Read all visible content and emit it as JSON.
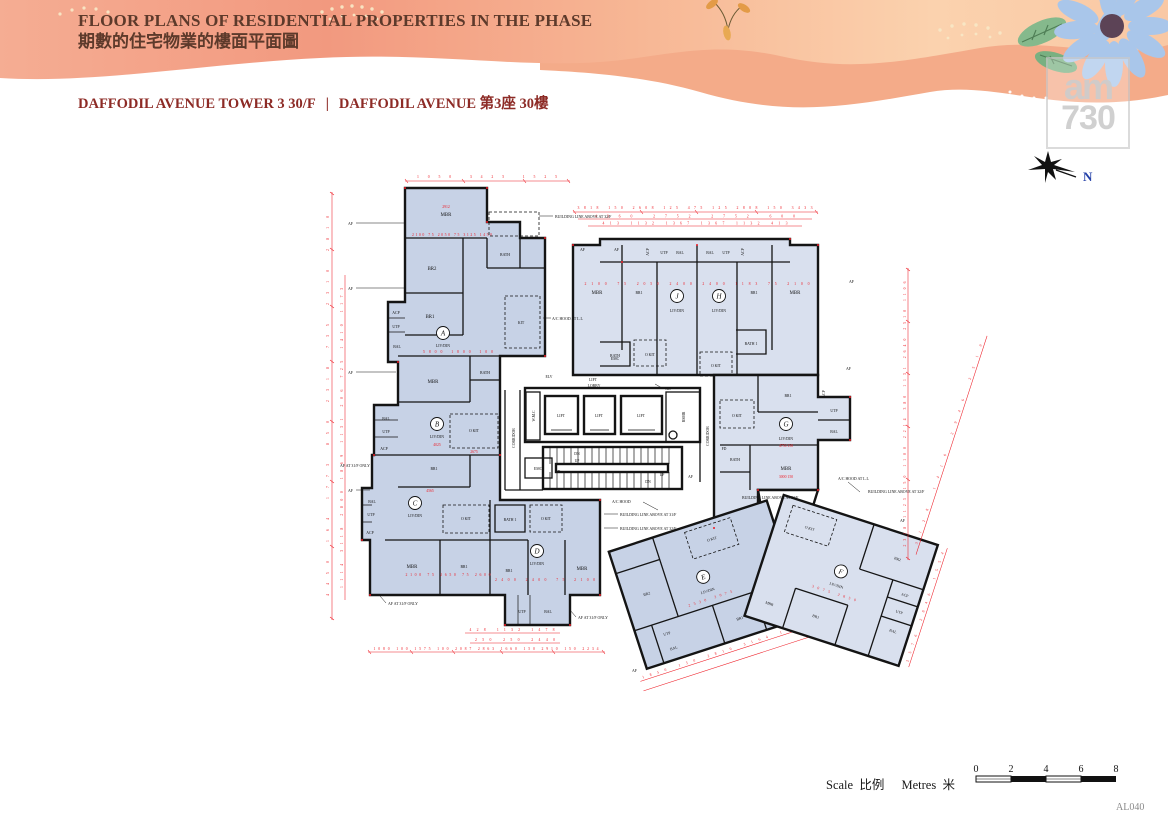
{
  "header": {
    "title_en": "FLOOR PLANS OF RESIDENTIAL PROPERTIES IN THE PHASE",
    "title_zh": "期數的住宅物業的樓面平面圖",
    "subtitle_tower_en": "DAFFODIL AVENUE TOWER 3  30/F",
    "subtitle_divider": "|",
    "subtitle_street_en": "DAFFODIL AVENUE",
    "subtitle_zh": "第3座 30樓"
  },
  "watermark": {
    "line1": "am",
    "line2": "730"
  },
  "compass": {
    "north": "N"
  },
  "page": {
    "code": "AL040"
  },
  "scale_bar": {
    "scale_en": "Scale",
    "scale_zh": "比例",
    "metres_en": "Metres",
    "metres_zh": "米",
    "ticks": [
      "0",
      "2",
      "4",
      "6",
      "8"
    ]
  },
  "units": {
    "A": "A",
    "B": "B",
    "C": "C",
    "D": "D",
    "E": "E",
    "F": "F",
    "G": "G",
    "H": "H",
    "J": "J"
  },
  "labels": {
    "livdin": "LIV/DIN",
    "mbr": "MBR",
    "br1": "BR1",
    "br2": "BR2",
    "bath": "BATH",
    "bath1": "BATH 1",
    "kit": "KIT",
    "okit": "O KIT",
    "bal": "BAL",
    "utp": "UTP",
    "acp": "ACP",
    "lift": "LIFT",
    "lobby": "LOBBY",
    "corridor": "CORRIDOR",
    "wmc": "W.M.C",
    "emc": "EMC",
    "rsmr": "RSMR",
    "pd": "PD",
    "hr": "HR",
    "elv": "ELV",
    "fd": "FD",
    "dn": "DN",
    "up": "UP",
    "af": "AF"
  },
  "annotations": {
    "building_line_32": "BUILDING LINE ABOVE AT 32/F",
    "building_line_31": "BUILDING LINE ABOVE AT 31/F",
    "ac_hood": "A/C HOOD",
    "ac_hood_ll": "A/C HOOD AT L.L",
    "af_31f_only": "AF AT 31/F ONLY"
  },
  "dims": {
    "top_a": "1050  3425  1525",
    "jh_row1": "3818 150 2608 125 475 125 2808 150 3433",
    "jh_row2": "4360    2752    2752    600",
    "jh_row3": "413 1132 1367    1367 1132 413",
    "left_1": "4450  164 1773  850  2318  735  2310  2810",
    "left_2": "1114  3118  2800  1869 1131 206  725  1410 1173",
    "right_1": "2318 1123 150 1100 2214 380 1131 2640 2510 1106",
    "right_2": "3128  1410  2946  2510",
    "bottom_1": "428 1132 1478",
    "bottom_2": "250 250  2440",
    "bottom_3": "1080 100 1575 100 2087  2863 1660 150 2910 150 2234",
    "wing_e": "1850 150 2816  3164  1554",
    "wing_f": "2576  2846  1554",
    "a_mbr": "2912",
    "a_beds": "2100 75 2050 75 3125 1450",
    "a_liv": "5800  1800 100",
    "b_liv": "4025",
    "b_okit": "2675",
    "c_liv": "4565",
    "c_beds": "2100 75 2650 75 2600",
    "d_beds": "2400   2400 75 2100",
    "d_low": "850  1600  1555   2012",
    "jh_beds": "2100 75 2050  2400  2400  1183 75 2100",
    "g_liv": "4750 150",
    "g_mbr": "3000 150",
    "e_liv": "2530  3075",
    "f_liv": "3075  2850"
  },
  "colors": {
    "banner_coral": "#f2997f",
    "banner_peach": "#f8c7a4",
    "accent_red": "#ee1c25",
    "plan_fill": "#c7d2e6",
    "title_brown": "#5d3a2b",
    "subtitle_red": "#8d2b26",
    "flower_blue": "#a9c6ea",
    "north_blue": "#2440a8"
  }
}
